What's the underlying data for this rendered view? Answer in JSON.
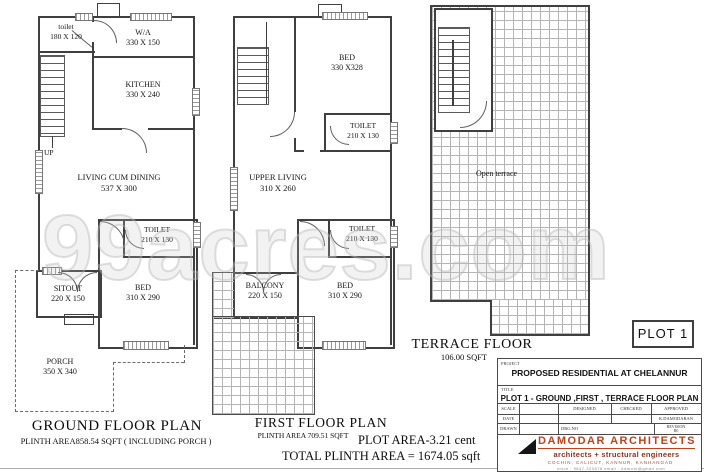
{
  "watermark": "99acres.com",
  "ground": {
    "title": "GROUND FLOOR PLAN",
    "subtitle": "PLINTH AREA858.54 SQFT ( INCLUDING PORCH )",
    "up": "UP",
    "rooms": [
      {
        "name": "toilet",
        "dim": "180 X 120"
      },
      {
        "name": "W/A",
        "dim": "330 X 150"
      },
      {
        "name": "KITCHEN",
        "dim": "330 X 240"
      },
      {
        "name": "LIVING CUM DINING",
        "dim": "537 X 300"
      },
      {
        "name": "TOILET",
        "dim": "210 X 130"
      },
      {
        "name": "SITOUT",
        "dim": "220 X 150"
      },
      {
        "name": "BED",
        "dim": "310 X 290"
      },
      {
        "name": "PORCH",
        "dim": "350 X 340"
      }
    ]
  },
  "first": {
    "title": "FIRST FLOOR PLAN",
    "subtitle": "PLINTH AREA 709.51 SQFT",
    "rooms": [
      {
        "name": "BED",
        "dim": "330 X328"
      },
      {
        "name": "TOILET",
        "dim": "210 X 130"
      },
      {
        "name": "UPPER LIVING",
        "dim": "310 X 260"
      },
      {
        "name": "TOILET",
        "dim": "210 X 130"
      },
      {
        "name": "BALCONY",
        "dim": "220 X 150"
      },
      {
        "name": "BED",
        "dim": "310 X 290"
      }
    ]
  },
  "terrace": {
    "title": "TERRACE FLOOR",
    "subtitle": "106.00 SQFT",
    "open_label": "Open terrace"
  },
  "summary": {
    "plot_area": "PLOT AREA-3.21 cent",
    "total_plinth": "TOTAL PLINTH AREA = 1674.05 sqft"
  },
  "plot_badge": "PLOT 1",
  "titleblock": {
    "project_label": "PROJECT",
    "project_value": "PROPOSED RESIDENTIAL  AT CHELANNUR",
    "title_label": "TITLE",
    "title_value": "PLOT 1 - GROUND ,FIRST , TERRACE FLOOR PLAN",
    "scale_label": "SCALE",
    "date_label": "DATE",
    "drawn_label": "DRAWN",
    "designed_label": "DESIGNED",
    "checked_label": "CHECKED",
    "approved_label": "APPROVED",
    "approved_by": "K.DAMODARAN",
    "drg_no_label": "DRG.NO",
    "revision_label": "REVISION",
    "revision_value": "R0",
    "firm_name": "DAMODAR ARCHITECTS",
    "firm_tagline": "architects + structural engineers",
    "firm_cities": "COCHIN, CALICUT, KANNUR, KANHANGAD",
    "firm_contact": "voice : 9847-320878   email : ddarchi@gmail.com"
  },
  "colors": {
    "line": "#3f3f3f",
    "accent_red": "#c2411b",
    "watermark_gray": "#dcdcdc"
  }
}
